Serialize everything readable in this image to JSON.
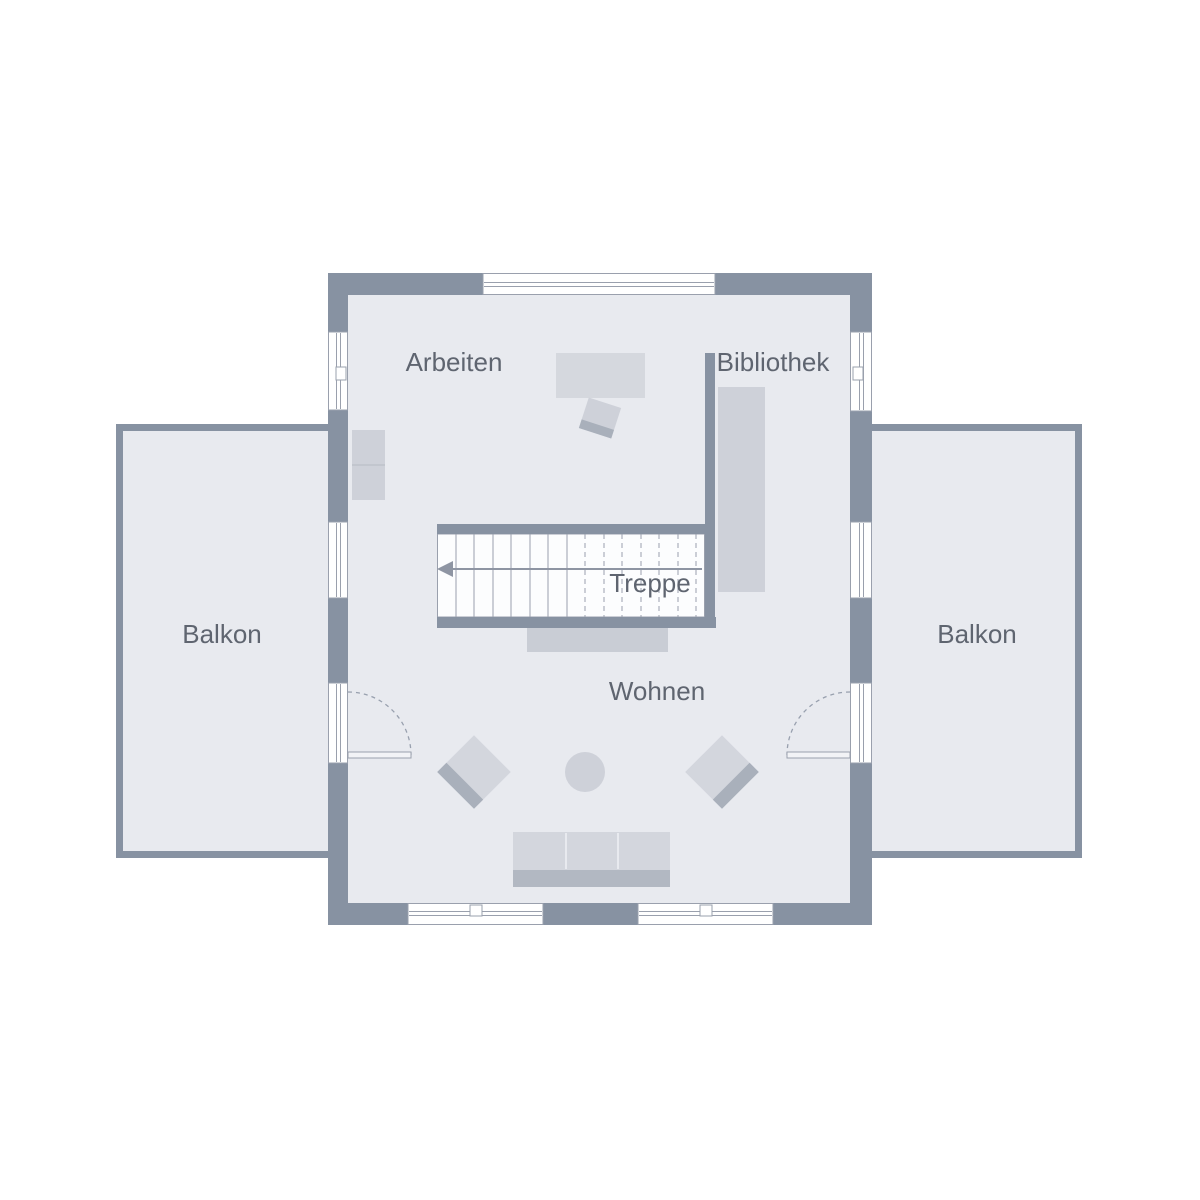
{
  "plan": {
    "type": "floor-plan",
    "floor": "upper-floor"
  },
  "rooms": {
    "arbeiten": {
      "label": "Arbeiten"
    },
    "bibliothek": {
      "label": "Bibliothek"
    },
    "treppe": {
      "label": "Treppe"
    },
    "wohnen": {
      "label": "Wohnen"
    },
    "balkon_left": {
      "label": "Balkon"
    },
    "balkon_right": {
      "label": "Balkon"
    }
  },
  "palette": {
    "wall": "#8792a2",
    "floor": "#e8eaef",
    "background": "#ffffff",
    "furniture_light": "#d3d6dd",
    "furniture_mid": "#ced1d9",
    "furniture_dark": "#a9b0bb",
    "sofa_base": "#b2b8c2",
    "stair_background": "#fcfdfe",
    "stair_line": "#9aa0ad",
    "label_text": "#5f6570"
  }
}
